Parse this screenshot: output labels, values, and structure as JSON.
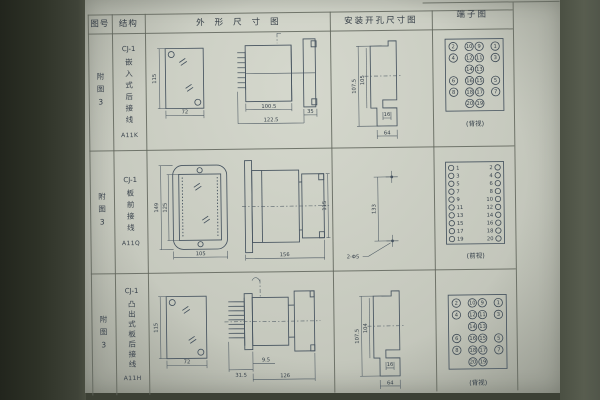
{
  "header": {
    "col_figure": "图号",
    "col_structure": "结构",
    "col_outline": "外形尺寸图",
    "col_install": "安装开孔尺寸图",
    "col_terminal": "端子图"
  },
  "rows": [
    {
      "figure": "附图3",
      "structure": {
        "model": "CJ-1",
        "type": "嵌入式后接线",
        "code": "A11K"
      },
      "outline": {
        "front_height": "115",
        "front_width": "72",
        "body_length": "100.5",
        "total_length": "122.5",
        "rear_length": "35"
      },
      "install": {
        "outer_height": "107.5",
        "inner_height": "105",
        "hole_offset": "16",
        "width": "64"
      },
      "terminal": {
        "view": "(背视)",
        "grid": [
          [
            "2",
            "10",
            "9",
            "1"
          ],
          [
            "4",
            "12",
            "11",
            "3"
          ],
          [
            "",
            "14",
            "13",
            ""
          ],
          [
            "6",
            "16",
            "15",
            "5"
          ],
          [
            "8",
            "18",
            "17",
            "7"
          ],
          [
            "",
            "20",
            "19",
            ""
          ]
        ]
      }
    },
    {
      "figure": "附图3",
      "structure": {
        "model": "CJ-1",
        "type": "板前接线",
        "code": "A11Q"
      },
      "outline": {
        "front_outer_height": "149",
        "front_inner_height": "125",
        "front_width": "105",
        "side_length": "156",
        "side_height": "115"
      },
      "install": {
        "hole_distance": "133",
        "holes": "2-Φ5"
      },
      "terminal": {
        "view": "(前视)",
        "pairs": [
          [
            "1",
            "2"
          ],
          [
            "3",
            "4"
          ],
          [
            "5",
            "6"
          ],
          [
            "7",
            "8"
          ],
          [
            "9",
            "10"
          ],
          [
            "11",
            "12"
          ],
          [
            "13",
            "14"
          ],
          [
            "15",
            "16"
          ],
          [
            "17",
            "18"
          ],
          [
            "19",
            "20"
          ]
        ]
      }
    },
    {
      "figure": "附图3",
      "structure": {
        "model": "CJ-1",
        "type": "凸出式板后接线",
        "code": "A11H"
      },
      "outline": {
        "front_height": "115",
        "front_width": "72",
        "pin_length": "31.5",
        "gap": "9.5",
        "body_length": "126"
      },
      "install": {
        "outer_height": "107.5",
        "inner_height": "104",
        "hole_offset": "16",
        "width": "64"
      },
      "terminal": {
        "view": "(背视)",
        "grid": [
          [
            "2",
            "10",
            "9",
            "1"
          ],
          [
            "4",
            "12",
            "11",
            "3"
          ],
          [
            "",
            "14",
            "13",
            ""
          ],
          [
            "6",
            "16",
            "15",
            "5"
          ],
          [
            "8",
            "18",
            "17",
            "7"
          ],
          [
            "",
            "20",
            "19",
            ""
          ]
        ]
      }
    }
  ],
  "colors": {
    "paper": "#cdd0c6",
    "ink": "#39424c",
    "table_line": "#5f645a",
    "drawing_stroke": "#46535f",
    "photo_edge": "#2e3227"
  }
}
